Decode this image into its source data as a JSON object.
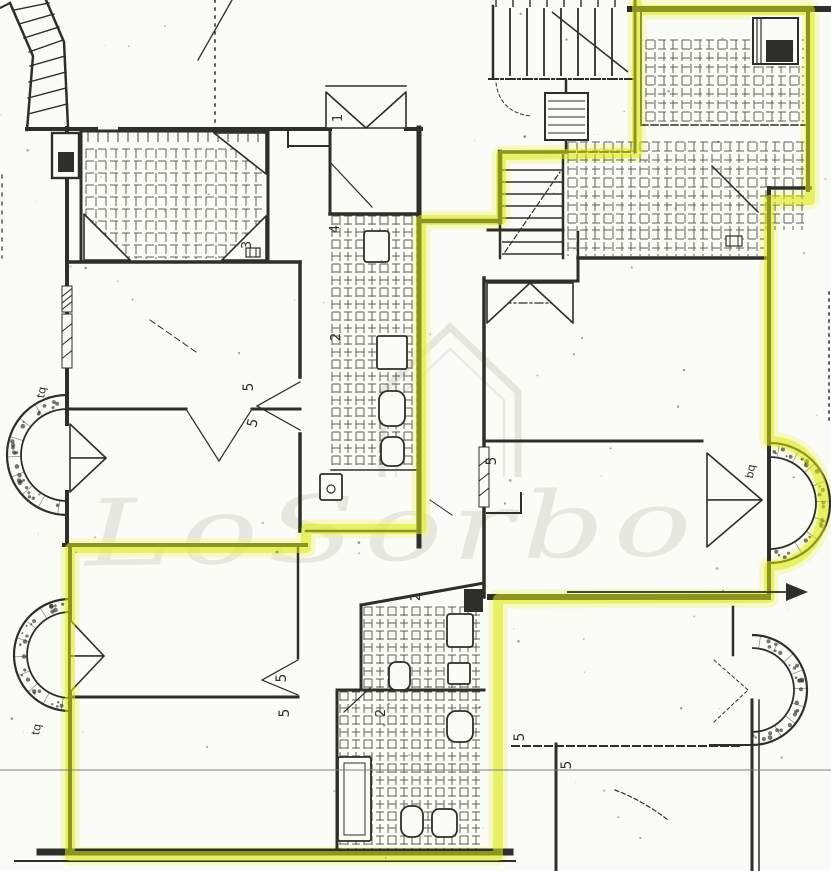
{
  "document": {
    "kind_label": "scanned cadastral floor plan with highlighted unit perimeter"
  },
  "colors": {
    "paper": "#fbfbf7",
    "ink": "#2e2e2a",
    "tile_line": "#45453e",
    "highlighter": "#dcea18",
    "highlighter_glow": "#f1f693",
    "watermark": "#d2d2ca",
    "fold_line": "#7c7c78"
  },
  "watermark": {
    "text": "LoSorbo"
  },
  "labels": [
    {
      "text": "1",
      "x": 342,
      "y": 118,
      "rot": -90,
      "size": 13
    },
    {
      "text": "4",
      "x": 339,
      "y": 229,
      "rot": -90,
      "size": 13
    },
    {
      "text": "2",
      "x": 340,
      "y": 337,
      "rot": -90,
      "size": 13
    },
    {
      "text": "3",
      "x": 251,
      "y": 245,
      "rot": -90,
      "size": 13
    },
    {
      "text": "5",
      "x": 253,
      "y": 387,
      "rot": -90,
      "size": 14
    },
    {
      "text": "5",
      "x": 257,
      "y": 424,
      "rot": -75,
      "size": 14
    },
    {
      "text": "5",
      "x": 286,
      "y": 678,
      "rot": -90,
      "size": 14
    },
    {
      "text": "5",
      "x": 289,
      "y": 713,
      "rot": -90,
      "size": 14
    },
    {
      "text": "5",
      "x": 496,
      "y": 461,
      "rot": -90,
      "size": 14
    },
    {
      "text": "5",
      "x": 524,
      "y": 737,
      "rot": -90,
      "size": 14
    },
    {
      "text": "5",
      "x": 571,
      "y": 765,
      "rot": -90,
      "size": 14
    },
    {
      "text": "2",
      "x": 420,
      "y": 597,
      "rot": -90,
      "size": 13
    },
    {
      "text": "2",
      "x": 385,
      "y": 713,
      "rot": -90,
      "size": 13
    },
    {
      "text": "tq",
      "x": 45,
      "y": 393,
      "rot": -80,
      "size": 11
    },
    {
      "text": "tq",
      "x": 40,
      "y": 730,
      "rot": -80,
      "size": 11
    },
    {
      "text": "bq",
      "x": 754,
      "y": 472,
      "rot": -80,
      "size": 11
    }
  ]
}
